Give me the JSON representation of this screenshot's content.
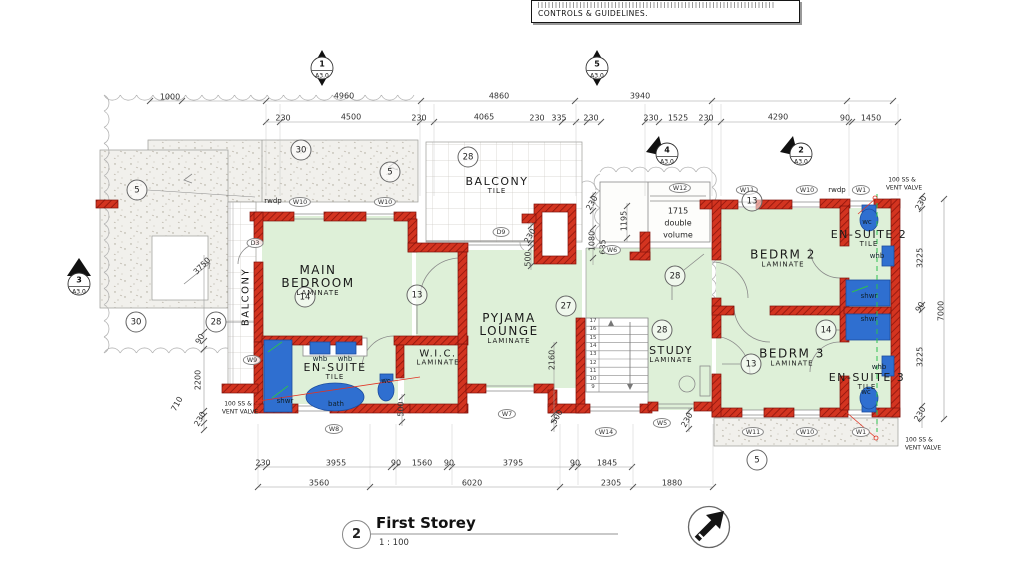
{
  "colors": {
    "wall_red": "#d33420",
    "wall_hatch": "#8d140b",
    "room_green": "#def0d8",
    "fixture_blue": "#2f6fd0",
    "fixture_dark": "#1c4d9e",
    "vent_green": "#2fbf4f",
    "leader_red": "#e03424",
    "line_gray": "#8a8a8a",
    "cloud_gray": "#b3b3b3",
    "dim": "#333333",
    "text": "#1a1a1a"
  },
  "note_box": {
    "line": "CONTROLS & GUIDELINES."
  },
  "title_block": {
    "number": "2",
    "title": "First Storey",
    "scale": "1 : 100"
  },
  "section_markers": [
    {
      "kind": "diamond",
      "num": "1",
      "sheet": "A3.0",
      "x": 322,
      "y": 68
    },
    {
      "kind": "diamond",
      "num": "5",
      "sheet": "A3.0",
      "x": 597,
      "y": 68
    },
    {
      "kind": "flag",
      "num": "4",
      "sheet": "A3.0",
      "x": 667,
      "y": 154
    },
    {
      "kind": "flag",
      "num": "2",
      "sheet": "A3.0",
      "x": 801,
      "y": 154
    },
    {
      "kind": "flagup",
      "num": "3",
      "sheet": "A3.0",
      "x": 79,
      "y": 284
    }
  ],
  "rooms": [
    {
      "name": "MAIN BEDROOM",
      "sub": "LAMINATE",
      "x": 318,
      "y": 281,
      "w": 112,
      "s": 12
    },
    {
      "name": "BALCONY",
      "sub": "TILE",
      "x": 497,
      "y": 186,
      "w": 120,
      "s": 11
    },
    {
      "name": "PYJAMA LOUNGE",
      "sub": "LAMINATE",
      "x": 509,
      "y": 329,
      "w": 102,
      "s": 12
    },
    {
      "name": "W.I.C.",
      "sub": "LAMINATE",
      "x": 438,
      "y": 358,
      "w": 90,
      "s": 10
    },
    {
      "name": "EN-SUITE",
      "sub": "TILE",
      "x": 335,
      "y": 372,
      "w": 120,
      "s": 11
    },
    {
      "name": "STUDY",
      "sub": "LAMINATE",
      "x": 671,
      "y": 355,
      "w": 90,
      "s": 11
    },
    {
      "name": "BEDRM 2",
      "sub": "LAMINATE",
      "x": 783,
      "y": 259,
      "w": 110,
      "s": 12
    },
    {
      "name": "EN-SUITE 2",
      "sub": "TILE",
      "x": 869,
      "y": 239,
      "w": 110,
      "s": 11
    },
    {
      "name": "BEDRM 3",
      "sub": "LAMINATE",
      "x": 792,
      "y": 358,
      "w": 110,
      "s": 12
    },
    {
      "name": "EN-SUITE 3",
      "sub": "TILE",
      "x": 867,
      "y": 382,
      "w": 110,
      "s": 11
    },
    {
      "name": "BALCONY",
      "sub": "",
      "x": 246,
      "y": 297,
      "w": 120,
      "s": 10,
      "r": -90
    }
  ],
  "fixture_labels": [
    {
      "t": "shwr",
      "x": 285,
      "y": 401
    },
    {
      "t": "bath",
      "x": 336,
      "y": 404
    },
    {
      "t": "wc",
      "x": 386,
      "y": 381
    },
    {
      "t": "whb",
      "x": 320,
      "y": 359
    },
    {
      "t": "whb",
      "x": 345,
      "y": 359
    },
    {
      "t": "wc",
      "x": 867,
      "y": 222
    },
    {
      "t": "whb",
      "x": 877,
      "y": 256
    },
    {
      "t": "shwr",
      "x": 869,
      "y": 296
    },
    {
      "t": "shwr",
      "x": 869,
      "y": 319
    },
    {
      "t": "whb",
      "x": 879,
      "y": 367
    },
    {
      "t": "wc",
      "x": 866,
      "y": 392
    }
  ],
  "window_tags": [
    {
      "t": "W10",
      "x": 300,
      "y": 202
    },
    {
      "t": "W10",
      "x": 385,
      "y": 202
    },
    {
      "t": "D3",
      "x": 255,
      "y": 243
    },
    {
      "t": "W9",
      "x": 252,
      "y": 360
    },
    {
      "t": "W8",
      "x": 334,
      "y": 429
    },
    {
      "t": "W7",
      "x": 507,
      "y": 414
    },
    {
      "t": "D9",
      "x": 501,
      "y": 232
    },
    {
      "t": "W6",
      "x": 612,
      "y": 250
    },
    {
      "t": "W12",
      "x": 680,
      "y": 188
    },
    {
      "t": "W11",
      "x": 747,
      "y": 190
    },
    {
      "t": "W10",
      "x": 807,
      "y": 190
    },
    {
      "t": "W1",
      "x": 861,
      "y": 190
    },
    {
      "t": "W14",
      "x": 606,
      "y": 432
    },
    {
      "t": "W5",
      "x": 662,
      "y": 423
    },
    {
      "t": "W11",
      "x": 753,
      "y": 432
    },
    {
      "t": "W10",
      "x": 807,
      "y": 432
    },
    {
      "t": "W1",
      "x": 861,
      "y": 432
    }
  ],
  "callouts": [
    {
      "t": "30",
      "x": 301,
      "y": 150
    },
    {
      "t": "5",
      "x": 390,
      "y": 172
    },
    {
      "t": "5",
      "x": 137,
      "y": 190
    },
    {
      "t": "30",
      "x": 136,
      "y": 322
    },
    {
      "t": "28",
      "x": 216,
      "y": 322
    },
    {
      "t": "28",
      "x": 468,
      "y": 157
    },
    {
      "t": "27",
      "x": 566,
      "y": 306
    },
    {
      "t": "28",
      "x": 675,
      "y": 276
    },
    {
      "t": "28",
      "x": 662,
      "y": 330
    },
    {
      "t": "13",
      "x": 417,
      "y": 295
    },
    {
      "t": "14",
      "x": 305,
      "y": 297
    },
    {
      "t": "13",
      "x": 752,
      "y": 201
    },
    {
      "t": "13",
      "x": 751,
      "y": 364
    },
    {
      "t": "14",
      "x": 826,
      "y": 330
    },
    {
      "t": "5",
      "x": 757,
      "y": 460
    }
  ],
  "dim_labels": [
    {
      "t": "1000",
      "x": 170,
      "y": 97
    },
    {
      "t": "4960",
      "x": 344,
      "y": 96
    },
    {
      "t": "4860",
      "x": 499,
      "y": 96
    },
    {
      "t": "3940",
      "x": 640,
      "y": 96
    },
    {
      "t": "230",
      "x": 283,
      "y": 118
    },
    {
      "t": "4500",
      "x": 351,
      "y": 117
    },
    {
      "t": "230",
      "x": 419,
      "y": 118
    },
    {
      "t": "4065",
      "x": 484,
      "y": 117
    },
    {
      "t": "230",
      "x": 537,
      "y": 118
    },
    {
      "t": "335",
      "x": 559,
      "y": 118
    },
    {
      "t": "230",
      "x": 591,
      "y": 118
    },
    {
      "t": "230",
      "x": 651,
      "y": 118
    },
    {
      "t": "1525",
      "x": 678,
      "y": 118
    },
    {
      "t": "230",
      "x": 706,
      "y": 118
    },
    {
      "t": "4290",
      "x": 778,
      "y": 117
    },
    {
      "t": "90",
      "x": 845,
      "y": 118
    },
    {
      "t": "1450",
      "x": 871,
      "y": 118
    },
    {
      "t": "3750",
      "x": 202,
      "y": 266,
      "r": -45
    },
    {
      "t": "90",
      "x": 200,
      "y": 339,
      "r": -60
    },
    {
      "t": "2200",
      "x": 198,
      "y": 380,
      "r": -90
    },
    {
      "t": "710",
      "x": 177,
      "y": 404,
      "r": -60
    },
    {
      "t": "230",
      "x": 200,
      "y": 419,
      "r": -60
    },
    {
      "t": "230",
      "x": 530,
      "y": 236,
      "r": -60
    },
    {
      "t": "500",
      "x": 528,
      "y": 259,
      "r": -90
    },
    {
      "t": "230",
      "x": 592,
      "y": 203,
      "r": -60
    },
    {
      "t": "1080",
      "x": 592,
      "y": 241,
      "r": -90
    },
    {
      "t": "635",
      "x": 603,
      "y": 247,
      "r": -90
    },
    {
      "t": "1195",
      "x": 624,
      "y": 221,
      "r": -90
    },
    {
      "t": "2160",
      "x": 552,
      "y": 360,
      "r": -90
    },
    {
      "t": "500",
      "x": 557,
      "y": 417,
      "r": -60
    },
    {
      "t": "500",
      "x": 401,
      "y": 409,
      "r": -90
    },
    {
      "t": "230",
      "x": 687,
      "y": 420,
      "r": -60
    },
    {
      "t": "230",
      "x": 921,
      "y": 203,
      "r": -60
    },
    {
      "t": "3225",
      "x": 920,
      "y": 258,
      "r": -90
    },
    {
      "t": "90",
      "x": 920,
      "y": 307,
      "r": -60
    },
    {
      "t": "3225",
      "x": 920,
      "y": 357,
      "r": -90
    },
    {
      "t": "230",
      "x": 920,
      "y": 414,
      "r": -60
    },
    {
      "t": "7000",
      "x": 941,
      "y": 311,
      "r": -90
    },
    {
      "t": "230",
      "x": 263,
      "y": 463
    },
    {
      "t": "3955",
      "x": 336,
      "y": 463
    },
    {
      "t": "90",
      "x": 396,
      "y": 463
    },
    {
      "t": "1560",
      "x": 422,
      "y": 463
    },
    {
      "t": "90",
      "x": 449,
      "y": 463
    },
    {
      "t": "3795",
      "x": 513,
      "y": 463
    },
    {
      "t": "90",
      "x": 575,
      "y": 463
    },
    {
      "t": "1845",
      "x": 607,
      "y": 463
    },
    {
      "t": "3560",
      "x": 319,
      "y": 483
    },
    {
      "t": "6020",
      "x": 472,
      "y": 483
    },
    {
      "t": "2305",
      "x": 611,
      "y": 483
    },
    {
      "t": "1880",
      "x": 672,
      "y": 483
    }
  ],
  "annotations": [
    {
      "t": "rwdp",
      "x": 273,
      "y": 201,
      "s": 7
    },
    {
      "t": "rwdp",
      "x": 837,
      "y": 190,
      "s": 7
    },
    {
      "t": "1715",
      "x": 678,
      "y": 211,
      "s": 8
    },
    {
      "t": "double",
      "x": 678,
      "y": 223,
      "s": 8
    },
    {
      "t": "volume",
      "x": 678,
      "y": 235,
      "s": 8
    },
    {
      "t": "100 SS &",
      "x": 238,
      "y": 404,
      "s": 6
    },
    {
      "t": "VENT VALVE",
      "x": 240,
      "y": 412,
      "s": 6
    },
    {
      "t": "100 SS &",
      "x": 902,
      "y": 180,
      "s": 6
    },
    {
      "t": "VENT VALVE",
      "x": 904,
      "y": 188,
      "s": 6
    },
    {
      "t": "100 SS &",
      "x": 919,
      "y": 440,
      "s": 6
    },
    {
      "t": "VENT VALVE",
      "x": 923,
      "y": 448,
      "s": 6
    }
  ],
  "stair_numbers": [
    "17",
    "16",
    "15",
    "14",
    "13",
    "12",
    "11",
    "10",
    "9"
  ]
}
